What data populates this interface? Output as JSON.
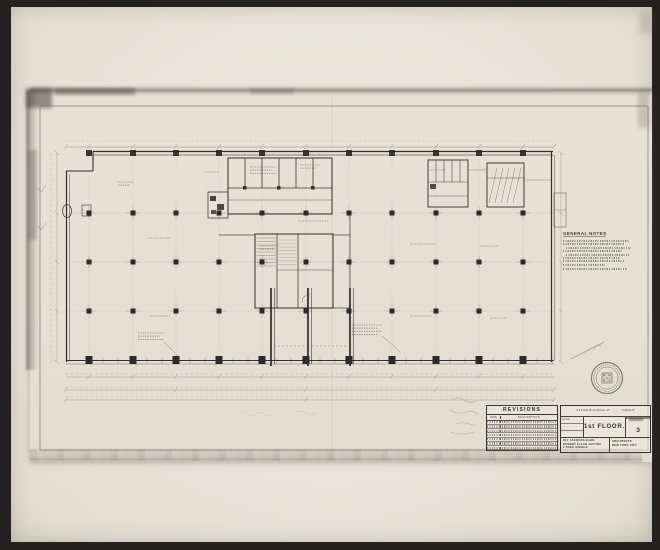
{
  "drawing": {
    "floor_label": "1st FLOOR.",
    "sheet_number": "3",
    "general_notes_title": "GENERAL NOTES",
    "title_block": {
      "project_line1": "OFFICE BUILDING AT ········ AVENUE",
      "project_line2": "··· ···· ········ ··· ·········",
      "scale_label": "SCALE",
      "cell2_label": "····",
      "cell3_label": "····",
      "firm_left_1": "ELY JACQUES KAHN",
      "firm_left_2": "ROBERT ALLAN JACOBS",
      "firm_left_3": "2 PARK AVENUE",
      "firm_right_1": "ARCHITECTS",
      "firm_right_2": "NEW YORK CITY"
    },
    "revisions": {
      "title": "REVISIONS",
      "date_col": "DATE",
      "desc_col": "DESCRIPTION"
    }
  },
  "colors": {
    "mount": "#24221f",
    "photo_paper": "#e9e5da",
    "sheet": "#e4e0d3",
    "ink": "#33302b",
    "pencil": "#8d877a"
  }
}
